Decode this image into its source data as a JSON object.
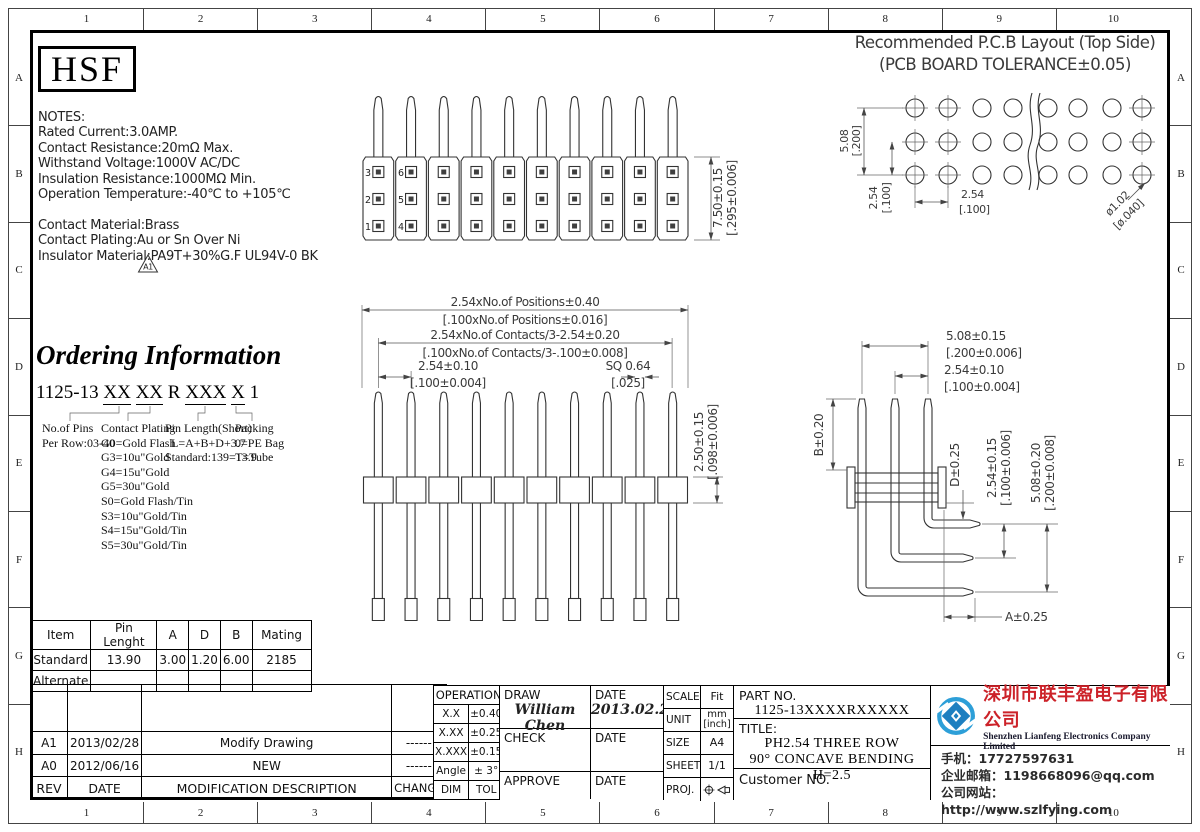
{
  "ruler": {
    "nums": [
      "1",
      "2",
      "3",
      "4",
      "5",
      "6",
      "7",
      "8",
      "9",
      "10"
    ],
    "letters": [
      "A",
      "B",
      "C",
      "D",
      "E",
      "F",
      "G",
      "H"
    ]
  },
  "logo": {
    "text": "HSF"
  },
  "notes": {
    "lines": [
      "NOTES:",
      "Rated Current:3.0AMP.",
      "Contact Resistance:20mΩ Max.",
      "Withstand Voltage:1000V AC/DC",
      "Insulation Resistance:1000MΩ Min.",
      "Operation Temperature:-40℃ to +105℃",
      "",
      "Contact Material:Brass",
      "Contact Plating:Au or Sn Over Ni",
      "Insulator Material:PA9T+30%G.F UL94V-0 BK"
    ],
    "triangle": "A1"
  },
  "pcb": {
    "title1": "Recommended P.C.B Layout (Top Side)",
    "title2": "(PCB BOARD TOLERANCE±0.05)"
  },
  "pins": {
    "c1": [
      "3",
      "2",
      "1"
    ],
    "c2": [
      "6",
      "5",
      "4"
    ]
  },
  "dims": {
    "tv_h": "7.50±0.15",
    "tv_h_in": "[.295±0.006]",
    "fv_w": "2.54xNo.of Positions±0.40",
    "fv_w_in": "[.100xNo.of Positions±0.016]",
    "fv_c": "2.54xNo.of Contacts/3-2.54±0.20",
    "fv_c_in": "[.100xNo.of Contacts/3-.100±0.008]",
    "fv_p": "2.54±0.10",
    "fv_p_in": "[.100±0.004]",
    "fv_sq": "SQ 0.64",
    "fv_sq_in": "[.025]",
    "fv_h": "2.50±0.15",
    "fv_h_in": "[.098±0.006]",
    "sv_w": "5.08±0.15",
    "sv_w_in": "[.200±0.006]",
    "sv_p": "2.54±0.10",
    "sv_p_in": "[.100±0.004]",
    "sv_b": "B±0.20",
    "sv_d": "D±0.25",
    "sv_r1": "2.54±0.15",
    "sv_r1_in": "[.100±0.006]",
    "sv_r2": "5.08±0.20",
    "sv_r2_in": "[.200±0.008]",
    "sv_a": "A±0.25",
    "pcb_rp": "5.08",
    "pcb_rp_in": "[.200]",
    "pcb_cp": "2.54",
    "pcb_cp_in": "[.100]",
    "pcb_hp": "2.54",
    "pcb_hp_in": "[.100]",
    "pcb_hole": "ø1.02",
    "pcb_hole_in": "[ø.040]"
  },
  "ordering": {
    "title": "Ordering Information",
    "pn": [
      {
        "t": "1125-13 "
      },
      {
        "t": "XX"
      },
      {
        "t": " "
      },
      {
        "t": "XX"
      },
      {
        "t": " R "
      },
      {
        "t": "XXX"
      },
      {
        "t": " "
      },
      {
        "t": "X"
      },
      {
        "t": " 1"
      }
    ],
    "col1": {
      "h": "No.of Pins",
      "l0": "Per Row:03-40"
    },
    "col2": {
      "h": "Contact Plating",
      "l0": "G0=Gold Flash",
      "l1": "G3=10u\"Gold",
      "l2": "G4=15u\"Gold",
      "l3": "G5=30u\"Gold",
      "l4": "S0=Gold Flash/Tin",
      "l5": "S3=10u\"Gold/Tin",
      "l6": "S4=15u\"Gold/Tin",
      "l7": "S5=30u\"Gold/Tin"
    },
    "col3": {
      "h": "Pin Length(Short)",
      "l0": "L=A+B+D+3.7",
      "l1": "Standard:139=13.9"
    },
    "col4": {
      "h": "Packing",
      "l0": "0=PE Bag",
      "l1": "T=Tube"
    }
  },
  "params": {
    "headers": [
      "Item",
      "Pin Lenght",
      "A",
      "D",
      "B",
      "Mating"
    ],
    "rows": [
      [
        "Standard",
        "13.90",
        "3.00",
        "1.20",
        "6.00",
        "2185"
      ],
      [
        "Alternate",
        "",
        "",
        "",
        "",
        ""
      ]
    ]
  },
  "revisions": {
    "rows": [
      {
        "rev": "A1",
        "date": "2013/02/28",
        "desc": "Modify Drawing",
        "change": "------"
      },
      {
        "rev": "A0",
        "date": "2012/06/16",
        "desc": "NEW",
        "change": "------"
      }
    ],
    "headers": {
      "rev": "REV",
      "date": "DATE",
      "desc": "MODIFICATION  DESCRIPTION",
      "change": "CHANGE"
    }
  },
  "tol": {
    "header": "OPERATION",
    "rows": [
      [
        "X.X",
        "±0.40"
      ],
      [
        "X.XX",
        "±0.25"
      ],
      [
        "X.XXX",
        "±0.15"
      ],
      [
        "Angle",
        "± 3°"
      ],
      [
        "DIM",
        "TOL"
      ]
    ]
  },
  "sign": {
    "draw_label": "DRAW",
    "draw_name": "William Chen",
    "date_label1": "DATE",
    "draw_date": "2013.02.28",
    "check_label": "CHECK",
    "date_label2": "DATE",
    "approve_label": "APPROVE",
    "date_label3": "DATE"
  },
  "meta": {
    "scale_label": "SCALE",
    "scale": "Fit",
    "unit_label": "UNIT",
    "unit": "mm",
    "unit2": "[inch]",
    "size_label": "SIZE",
    "size": "A4",
    "sheet_label": "SHEET",
    "sheet": "1/1",
    "proj_label": "PROJ."
  },
  "part": {
    "label": "PART NO.",
    "value": "1125-13XXXXRXXXXX",
    "title_label": "TITLE:",
    "title1": "PH2.54 THREE ROW",
    "title2": "90° CONCAVE BENDING H=2.5",
    "customer": "Customer NO."
  },
  "company": {
    "name_cn": "深圳市联丰盈电子有限公司",
    "name_en": "Shenzhen Lianfeng Electronics Company Limited",
    "phone_label": "手机：",
    "phone": "17727597631",
    "email_label": "企业邮箱：",
    "email": "1198668096@qq.com",
    "web_label": "公司网站：",
    "web": "http://www.szlfying.com",
    "name_color": "#cc2229",
    "logo_blue": "#2d9fd8",
    "logo_dark_blue": "#1e7fc0"
  }
}
